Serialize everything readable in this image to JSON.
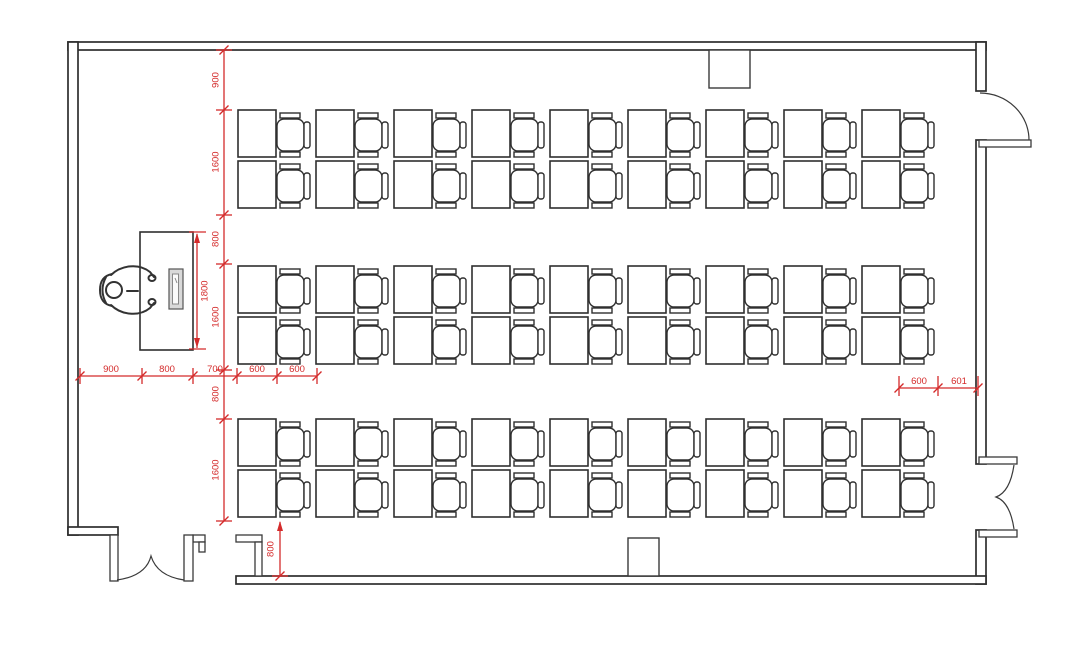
{
  "meta": {
    "drawing_type": "classroom-furniture-floor-plan"
  },
  "palette": {
    "dimension_red": "#d42b2b",
    "line_black": "#2e2e2e",
    "background": "#ffffff",
    "laptop_fill": "#d9d9d9"
  },
  "dimensions": {
    "left_chain": [
      "900",
      "1600",
      "800",
      "1600",
      "800",
      "1600"
    ],
    "bottom_chain": [
      "900",
      "800",
      "700",
      "600",
      "600"
    ],
    "right_chain": [
      "600",
      "601"
    ],
    "teacher_desk": "1800",
    "entry": "800"
  },
  "desk_grid": {
    "columns": 9,
    "rows": 3,
    "seats_per_column": 2,
    "total_seats": 54
  },
  "fixtures": [
    "teacher-desk",
    "teacher-person",
    "laptop-on-desk",
    "wall-column-top",
    "wall-column-bottom",
    "single-swing-door-top-right",
    "double-swing-door-bottom-right",
    "double-swing-door-entry-left"
  ]
}
